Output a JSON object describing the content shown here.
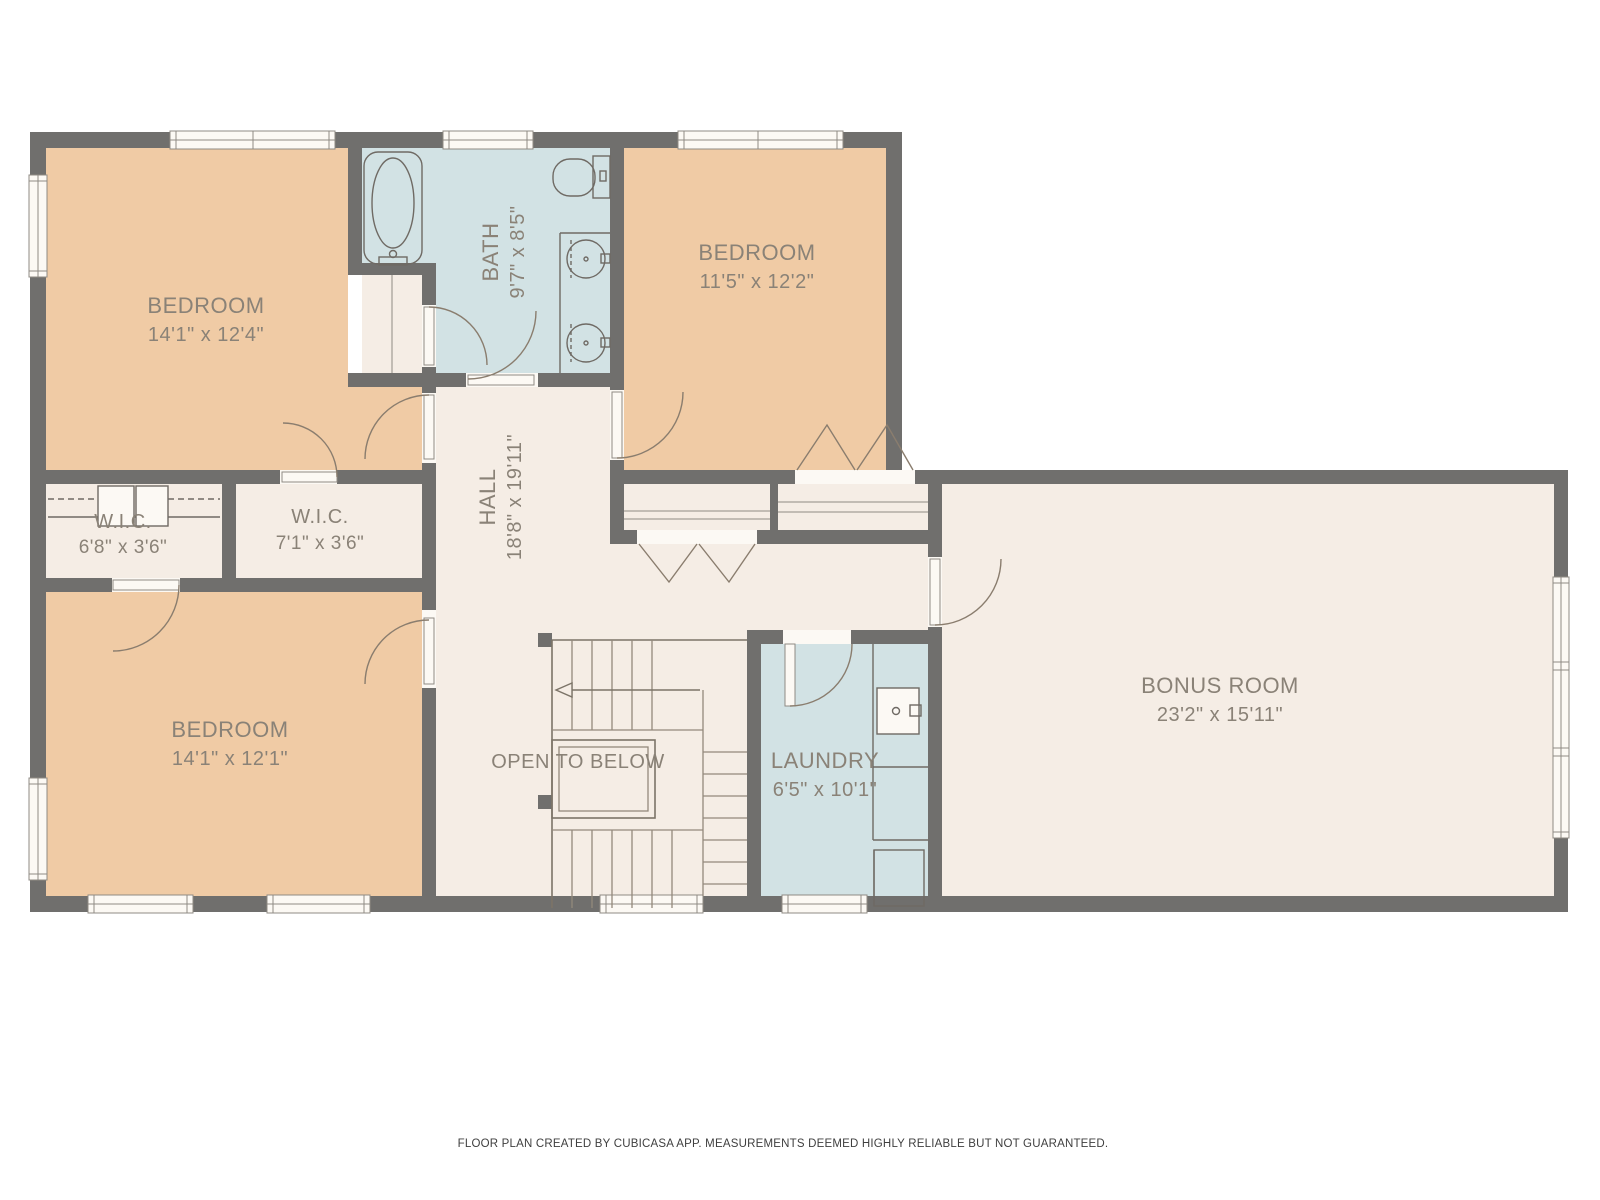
{
  "meta": {
    "footer": "FLOOR PLAN CREATED BY CUBICASA APP. MEASUREMENTS DEEMED HIGHLY RELIABLE BUT NOT GUARANTEED."
  },
  "rooms": {
    "bedroom_top_left": {
      "name": "BEDROOM",
      "dims": "14'1\" x 12'4\""
    },
    "bath": {
      "name": "BATH",
      "dims": "9'7\" x 8'5\""
    },
    "bedroom_top_right": {
      "name": "BEDROOM",
      "dims": "11'5\" x 12'2\""
    },
    "wic_left": {
      "name": "W.I.C.",
      "dims": "6'8\" x 3'6\""
    },
    "wic_right": {
      "name": "W.I.C.",
      "dims": "7'1\" x 3'6\""
    },
    "hall": {
      "name": "HALL",
      "dims": "18'8\" x 19'11\""
    },
    "bedroom_bottom_left": {
      "name": "BEDROOM",
      "dims": "14'1\" x 12'1\""
    },
    "open_to_below": {
      "name": "OPEN TO BELOW"
    },
    "laundry": {
      "name": "LAUNDRY",
      "dims": "6'5\" x 10'1\""
    },
    "bonus_room": {
      "name": "BONUS ROOM",
      "dims": "23'2\" x 15'11\""
    }
  },
  "colors": {
    "wall": "#706f6d",
    "room_tan": "#f0cba5",
    "room_blue": "#d2e2e4",
    "room_cream": "#f5ede5",
    "window_fill": "#fcf9f4",
    "frame": "#8f8b84",
    "fixture": "#6f6a64",
    "arc": "#8a7d6e",
    "stair": "#93897c",
    "stair_dark": "#7c7468",
    "label": "#8a8277",
    "footer_text": "#3f3f3f"
  }
}
